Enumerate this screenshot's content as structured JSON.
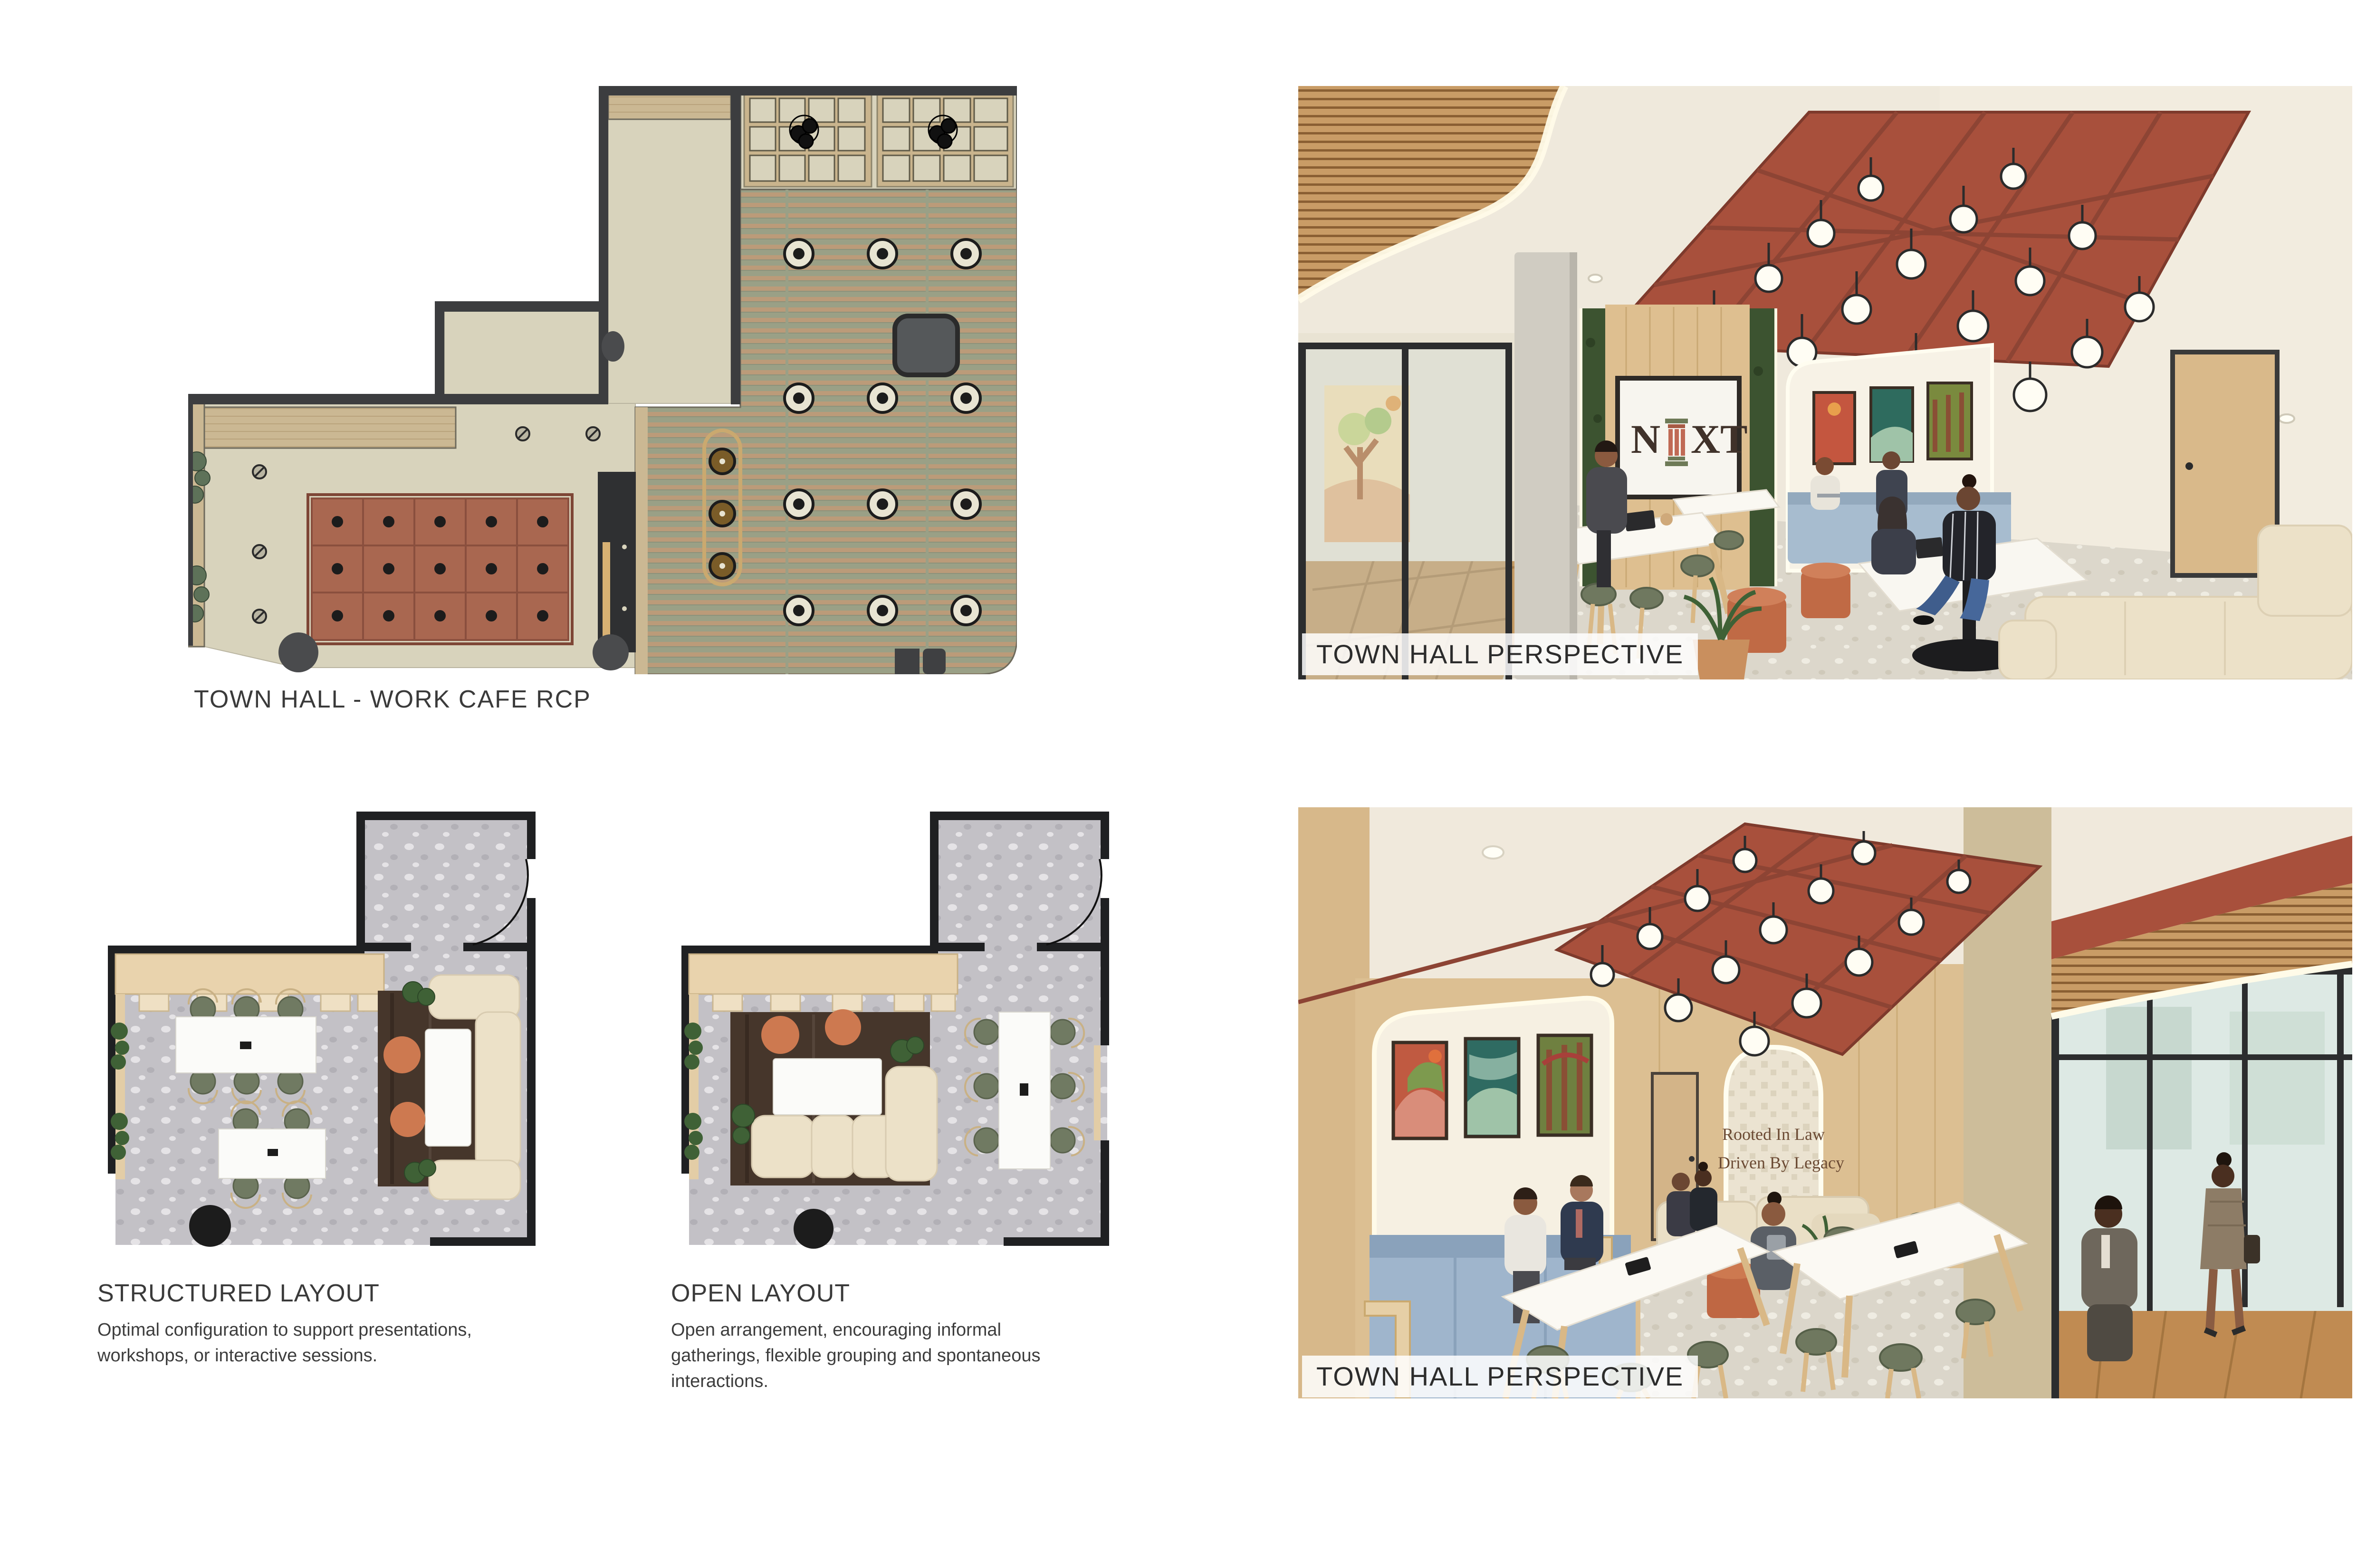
{
  "board": {
    "type": "interior design presentation board",
    "background": "#ffffff"
  },
  "rcp_plan": {
    "title": "TOWN HALL - WORK CAFE RCP"
  },
  "perspective_top": {
    "label": "TOWN HALL PERSPECTIVE",
    "logo_n": "N",
    "logo_xt": "XT",
    "logo_full": "NEXT"
  },
  "perspective_bottom": {
    "label": "TOWN HALL PERSPECTIVE",
    "quote_line1": "Rooted In Law",
    "quote_line2": "Driven By Legacy"
  },
  "layout_options": [
    {
      "heading": "STRUCTURED LAYOUT",
      "description": "Optimal configuration to support presentations, workshops, or interactive sessions."
    },
    {
      "heading": "OPEN LAYOUT",
      "description": "Open arrangement, encouraging informal gatherings, flexible grouping and spontaneous interactions."
    }
  ],
  "colors": {
    "plan_wall_dark": "#3c3d3f",
    "plan_ceiling_cream": "#d8d3bc",
    "plan_coffer_red": "#a96750",
    "plan_slat_wood": "#bb9b79",
    "plan_slat_bg": "#9aa086",
    "plan_beam_wood": "#c9b48d",
    "render_red_ceiling": "#a8503c",
    "render_wood": "#dcbf92",
    "moss_green": "#3c5330",
    "banquette_blue": "#a3b9ce",
    "pouf_orange": "#c8714b",
    "chair_olive": "#6f785f",
    "sofa_cream": "#ece1c8",
    "terrazzo": "#d8d3c8",
    "logo_brown": "#40322a",
    "quote_brown": "#6b4a33"
  }
}
